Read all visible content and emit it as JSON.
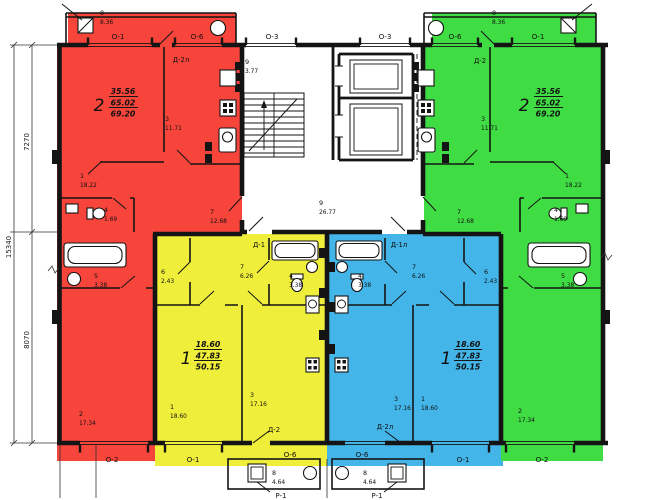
{
  "plan": {
    "dims": {
      "left_top": "7270",
      "left_bottom": "8070",
      "left_total": "15340"
    },
    "windows": {
      "top": [
        "О-1",
        "О-6",
        "О-3",
        "О-3",
        "О-6",
        "О-1"
      ],
      "bottom": [
        "О-2",
        "О-1",
        "О-6",
        "О-6",
        "О-1",
        "О-2"
      ]
    },
    "core": {
      "stair_num": "9",
      "stair_area": "3.77",
      "corridor_num": "9",
      "corridor_area": "26.77"
    },
    "porch_left": {
      "num": "8",
      "area": "4.64",
      "panel": "Р-1"
    },
    "porch_right": {
      "num": "8",
      "area": "4.64",
      "panel": "Р-1"
    },
    "apt_red": {
      "num": "2",
      "living": "35.56",
      "total": "65.02",
      "full": "69.20",
      "balcony_num": "8",
      "balcony_area": "8.36",
      "door_balcony": "Д-2л",
      "r_kitchen_n": "3",
      "r_kitchen_a": "11.71",
      "r1_n": "1",
      "r1_a": "18.22",
      "r_wc_n": "4",
      "r_wc_a": "1.69",
      "r_hall_n": "7",
      "r_hall_a": "12.68",
      "r_bath_n": "5",
      "r_bath_a": "3.38",
      "r2_n": "2",
      "r2_a": "17.34"
    },
    "apt_green": {
      "num": "2",
      "living": "35.56",
      "total": "65.02",
      "full": "69.20",
      "balcony_num": "8",
      "balcony_area": "8.36",
      "door_balcony": "Д-2",
      "r_kitchen_n": "3",
      "r_kitchen_a": "11.71",
      "r1_n": "1",
      "r1_a": "18.22",
      "r_wc_n": "4",
      "r_wc_a": "1.69",
      "r_hall_n": "7",
      "r_hall_a": "12.68",
      "r_bath_n": "5",
      "r_bath_a": "3.38",
      "r2_n": "2",
      "r2_a": "17.34"
    },
    "apt_yellow": {
      "num": "1",
      "living": "18.60",
      "total": "47.83",
      "full": "50.15",
      "door_entry": "Д-1",
      "door_balcony": "Д-2",
      "r_closet_n": "6",
      "r_closet_a": "2.43",
      "r_hall_n": "7",
      "r_hall_a": "6.26",
      "r_bath_n": "4",
      "r_bath_a": "3.38",
      "r1_n": "1",
      "r1_a": "18.60",
      "r3_n": "3",
      "r3_a": "17.16"
    },
    "apt_blue": {
      "num": "1",
      "living": "18.60",
      "total": "47.83",
      "full": "50.15",
      "door_entry": "Д-1л",
      "door_balcony": "Д-2л",
      "r_closet_n": "6",
      "r_closet_a": "2.43",
      "r_hall_n": "7",
      "r_hall_a": "6.26",
      "r_bath_n": "4",
      "r_bath_a": "3.38",
      "r1_n": "1",
      "r1_a": "18.60",
      "r3_n": "3",
      "r3_a": "17.16"
    },
    "colors": {
      "red": "#f8453c",
      "yellow": "#efee3a",
      "blue": "#44b5e9",
      "green": "#40dc44"
    }
  }
}
